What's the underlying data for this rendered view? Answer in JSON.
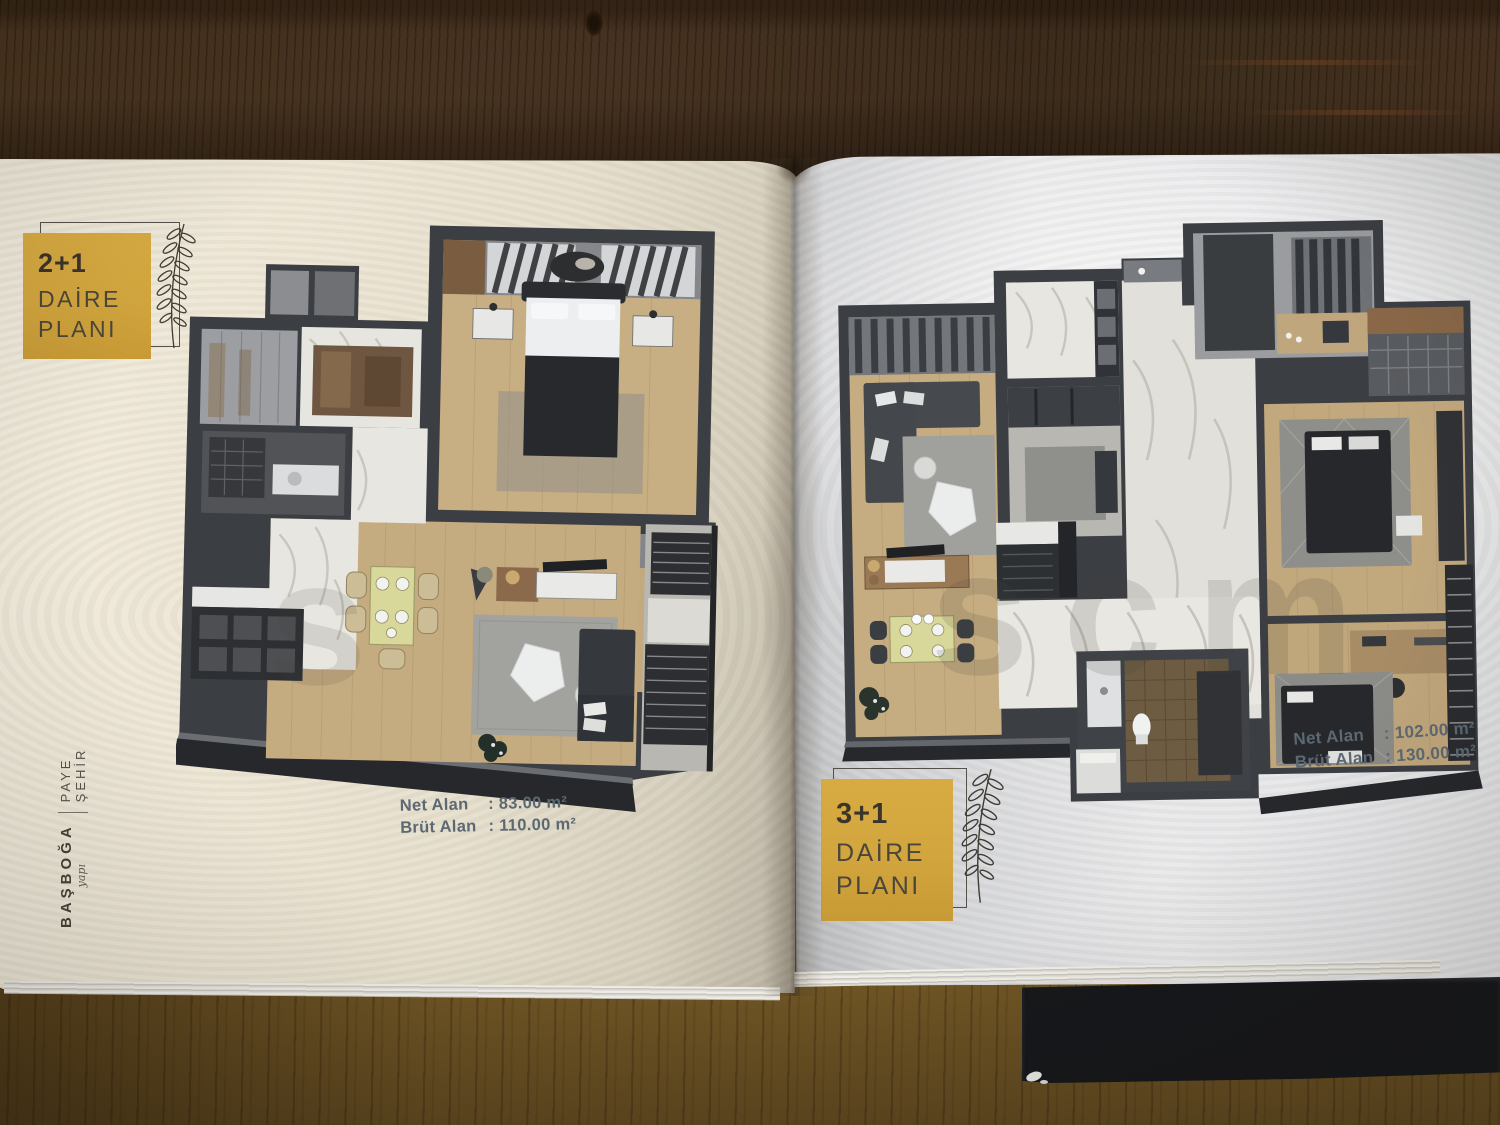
{
  "left_page": {
    "badge": {
      "units": "2+1",
      "word1": "DAİRE",
      "word2": "PLANI"
    },
    "areas": {
      "net": {
        "label": "Net Alan",
        "value": ": 83.00 m²"
      },
      "brut": {
        "label": "Brüt Alan",
        "value": ": 110.00 m²"
      }
    },
    "watermark": "s",
    "plan_description": "2+1 apartment 3D floor plan render"
  },
  "right_page": {
    "badge": {
      "units": "3+1",
      "word1": "DAİRE",
      "word2": "PLANI"
    },
    "areas": {
      "net": {
        "label": "Net Alan",
        "value": ": 102.00 m²"
      },
      "brut": {
        "label": "Brüt Alan",
        "value": ": 130.00 m²"
      }
    },
    "watermark": "scm",
    "plan_description": "3+1 apartment 3D floor plan render"
  },
  "brand": {
    "name": "BAŞBOĞA",
    "script": "yapı",
    "project": "PAYE ŞEHİR"
  },
  "colors": {
    "badge_gold": "#d2a53e",
    "badge_text": "#4b463a",
    "area_text": "#5c6973",
    "page_left_cream": "#ece5d4",
    "page_right_gray": "#e6e6e8",
    "table_wood_dark": "#46321f",
    "table_wood_golden": "#6f5426",
    "plan_wall_charcoal": "#3b3e43",
    "plan_floor_wood": "#c5ac81",
    "plan_marble": "#e8e6e0",
    "dining_table_yellow": "#d9d89b"
  }
}
